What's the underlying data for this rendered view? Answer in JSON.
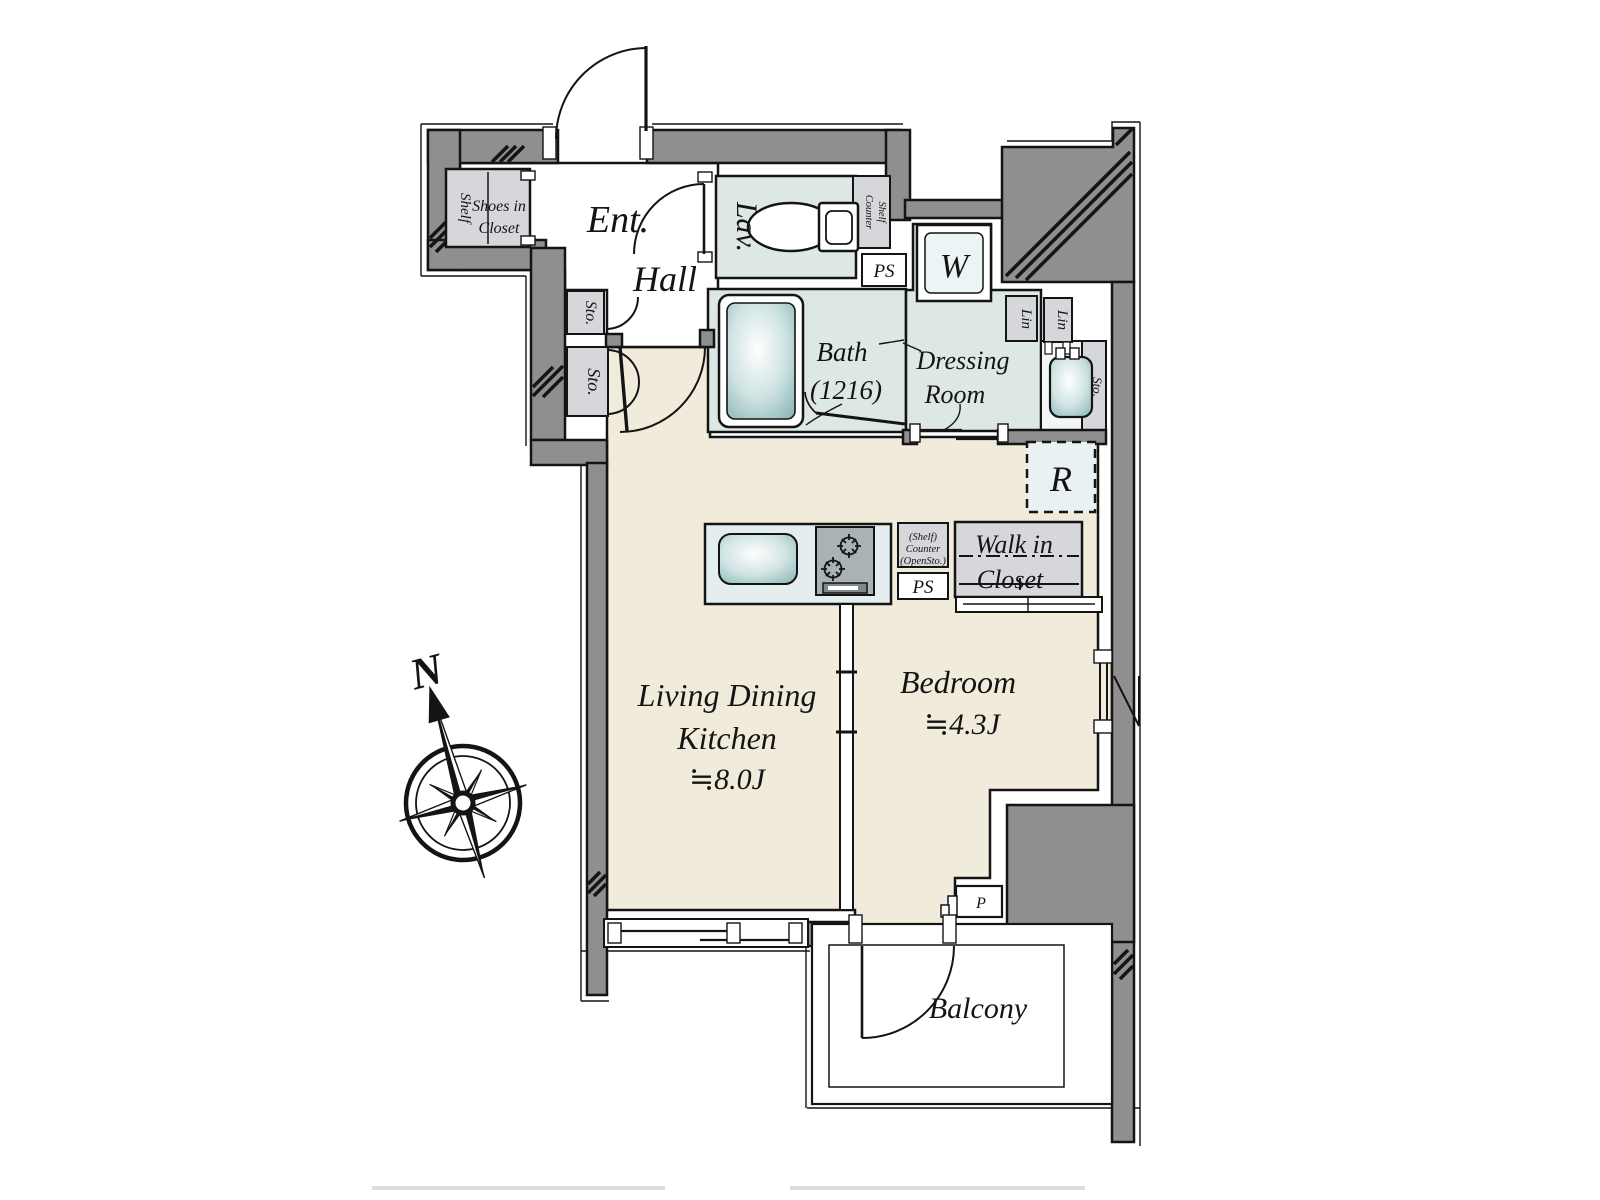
{
  "plan": {
    "rooms": {
      "entrance": "Ent.",
      "hall": "Hall",
      "lavatory": "Lav.",
      "bath_line1": "Bath",
      "bath_line2": "(1216)",
      "dressing_line1": "Dressing",
      "dressing_line2": "Room",
      "ldk_line1": "Living Dining",
      "ldk_line2": "Kitchen",
      "ldk_size": "≒8.0J",
      "bedroom": "Bedroom",
      "bedroom_size": "≒4.3J",
      "balcony": "Balcony",
      "wic_line1": "Walk in",
      "wic_line2": "Closet"
    },
    "fixtures": {
      "washer": "W",
      "refrigerator": "R",
      "pipe_space_top": "PS",
      "pipe_space_kitchen": "PS",
      "pipe": "P",
      "linen1": "Lin",
      "linen2": "Lin",
      "storage_hall": "Sto.",
      "storage_ldk": "Sto.",
      "storage_basin": "Sto.",
      "shoes_line1": "Shoes in",
      "shoes_line2": "Closet",
      "shoes_shelf": "Shelf",
      "counter_shelf_line1": "Counter",
      "counter_shelf_line2": "Shelf",
      "open_counter_line1": "(Shelf)",
      "open_counter_line2": "Counter",
      "open_counter_line3": "(OpenSto.)"
    },
    "compass": {
      "north": "N"
    },
    "colors": {
      "wall": "#8f8f8f",
      "floor_living": "#f1ebdb",
      "floor_wet": "#dde7e3",
      "closet_fill": "#d6d7db",
      "counter_fill": "#e4eeef",
      "appliance_fill": "#edf4f5",
      "fixture_teal": "#8fb9ba",
      "line": "#141414"
    }
  }
}
